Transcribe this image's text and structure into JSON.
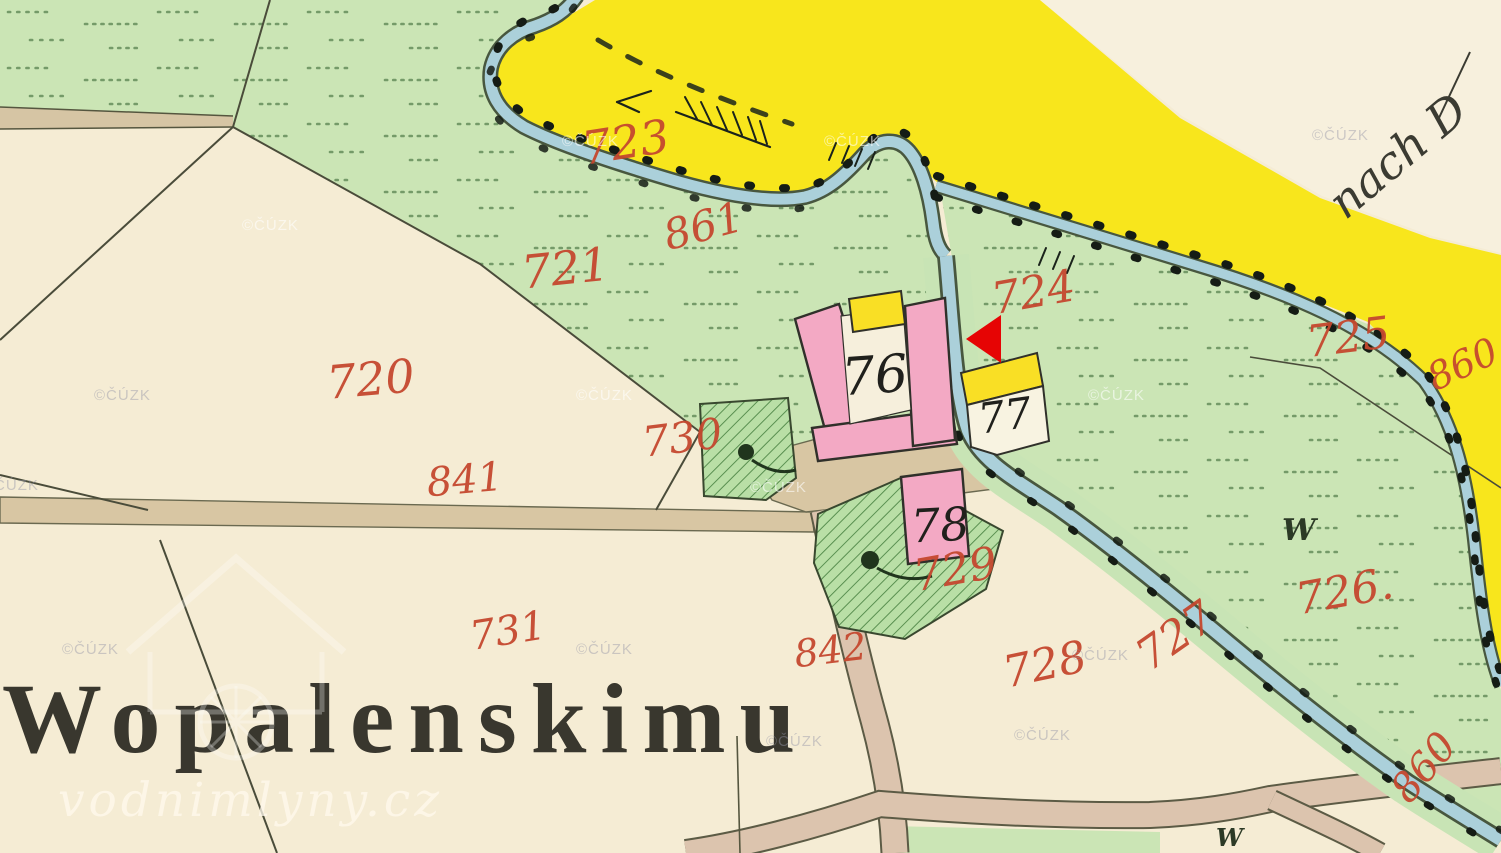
{
  "map": {
    "title_label": "Wopalenskimu",
    "direction_note": "nach D",
    "meadow_symbol": "W",
    "copyright_watermark": "©ČÚZK",
    "site_watermark": "vodnimlyny.cz",
    "colors": {
      "field_cream": "#f5ecd4",
      "field_cream_light": "#f7f0dd",
      "meadow_green": "#cbe5b5",
      "road_yellow": "#f8e61c",
      "stream_blue": "#abd0da",
      "building_pink": "#f3a9c4",
      "roof_yellow": "#f9df25",
      "road_tan": "#d8c6a3",
      "label_red": "#c5482f",
      "marker_red": "#e60404"
    },
    "parcel_labels": [
      {
        "text": "723"
      },
      {
        "text": "861"
      },
      {
        "text": "721"
      },
      {
        "text": "720"
      },
      {
        "text": "724"
      },
      {
        "text": "725"
      },
      {
        "text": "730"
      },
      {
        "text": "841"
      },
      {
        "text": "731"
      },
      {
        "text": "842"
      },
      {
        "text": "729"
      },
      {
        "text": "728"
      },
      {
        "text": "727"
      },
      {
        "text": "726."
      },
      {
        "text": "860"
      },
      {
        "text": "860"
      }
    ],
    "building_numbers": [
      {
        "text": "76"
      },
      {
        "text": "77"
      },
      {
        "text": "78"
      }
    ]
  }
}
